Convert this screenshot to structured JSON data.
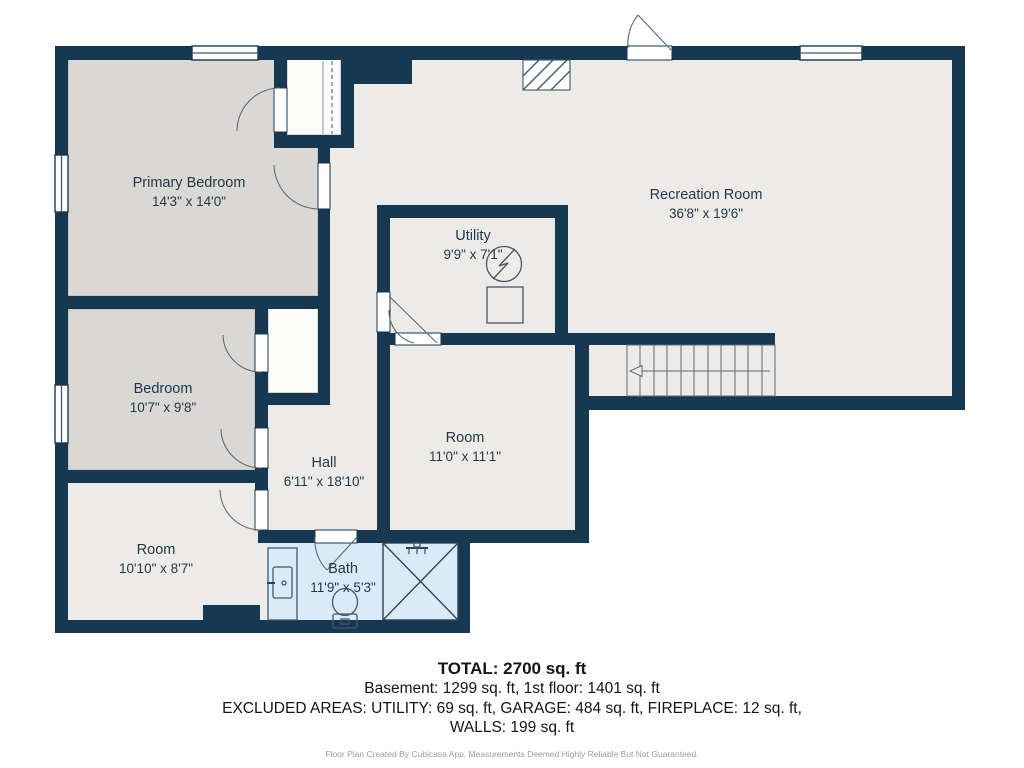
{
  "colors": {
    "wall": "#163850",
    "floor": "#edebe8",
    "bedroom_floor": "#d9d8d5",
    "bath_floor": "#d9ebf7",
    "label_text": "#22384c",
    "page_background": "#ffffff"
  },
  "rooms": {
    "primary_bedroom": {
      "name": "Primary Bedroom",
      "dims": "14'3\" x 14'0\""
    },
    "recreation_room": {
      "name": "Recreation Room",
      "dims": "36'8\" x 19'6\""
    },
    "utility": {
      "name": "Utility",
      "dims": "9'9\" x 7'1\""
    },
    "bedroom": {
      "name": "Bedroom",
      "dims": "10'7\" x 9'8\""
    },
    "hall": {
      "name": "Hall",
      "dims": "6'11\" x 18'10\""
    },
    "room_center": {
      "name": "Room",
      "dims": "11'0\" x 11'1\""
    },
    "room_southwest": {
      "name": "Room",
      "dims": "10'10\" x 8'7\""
    },
    "bath": {
      "name": "Bath",
      "dims": "11'9\" x 5'3\""
    }
  },
  "summary": {
    "total": "TOTAL: 2700 sq. ft",
    "floors": "Basement: 1299 sq. ft, 1st floor: 1401 sq. ft",
    "excluded": "EXCLUDED AREAS: UTILITY: 69 sq. ft, GARAGE: 484 sq. ft, FIREPLACE: 12 sq. ft,",
    "walls": "WALLS: 199 sq. ft",
    "disclaimer": "Floor Plan Created By Cubicasa App. Measurements Deemed Highly Reliable But Not Guaranteed."
  }
}
